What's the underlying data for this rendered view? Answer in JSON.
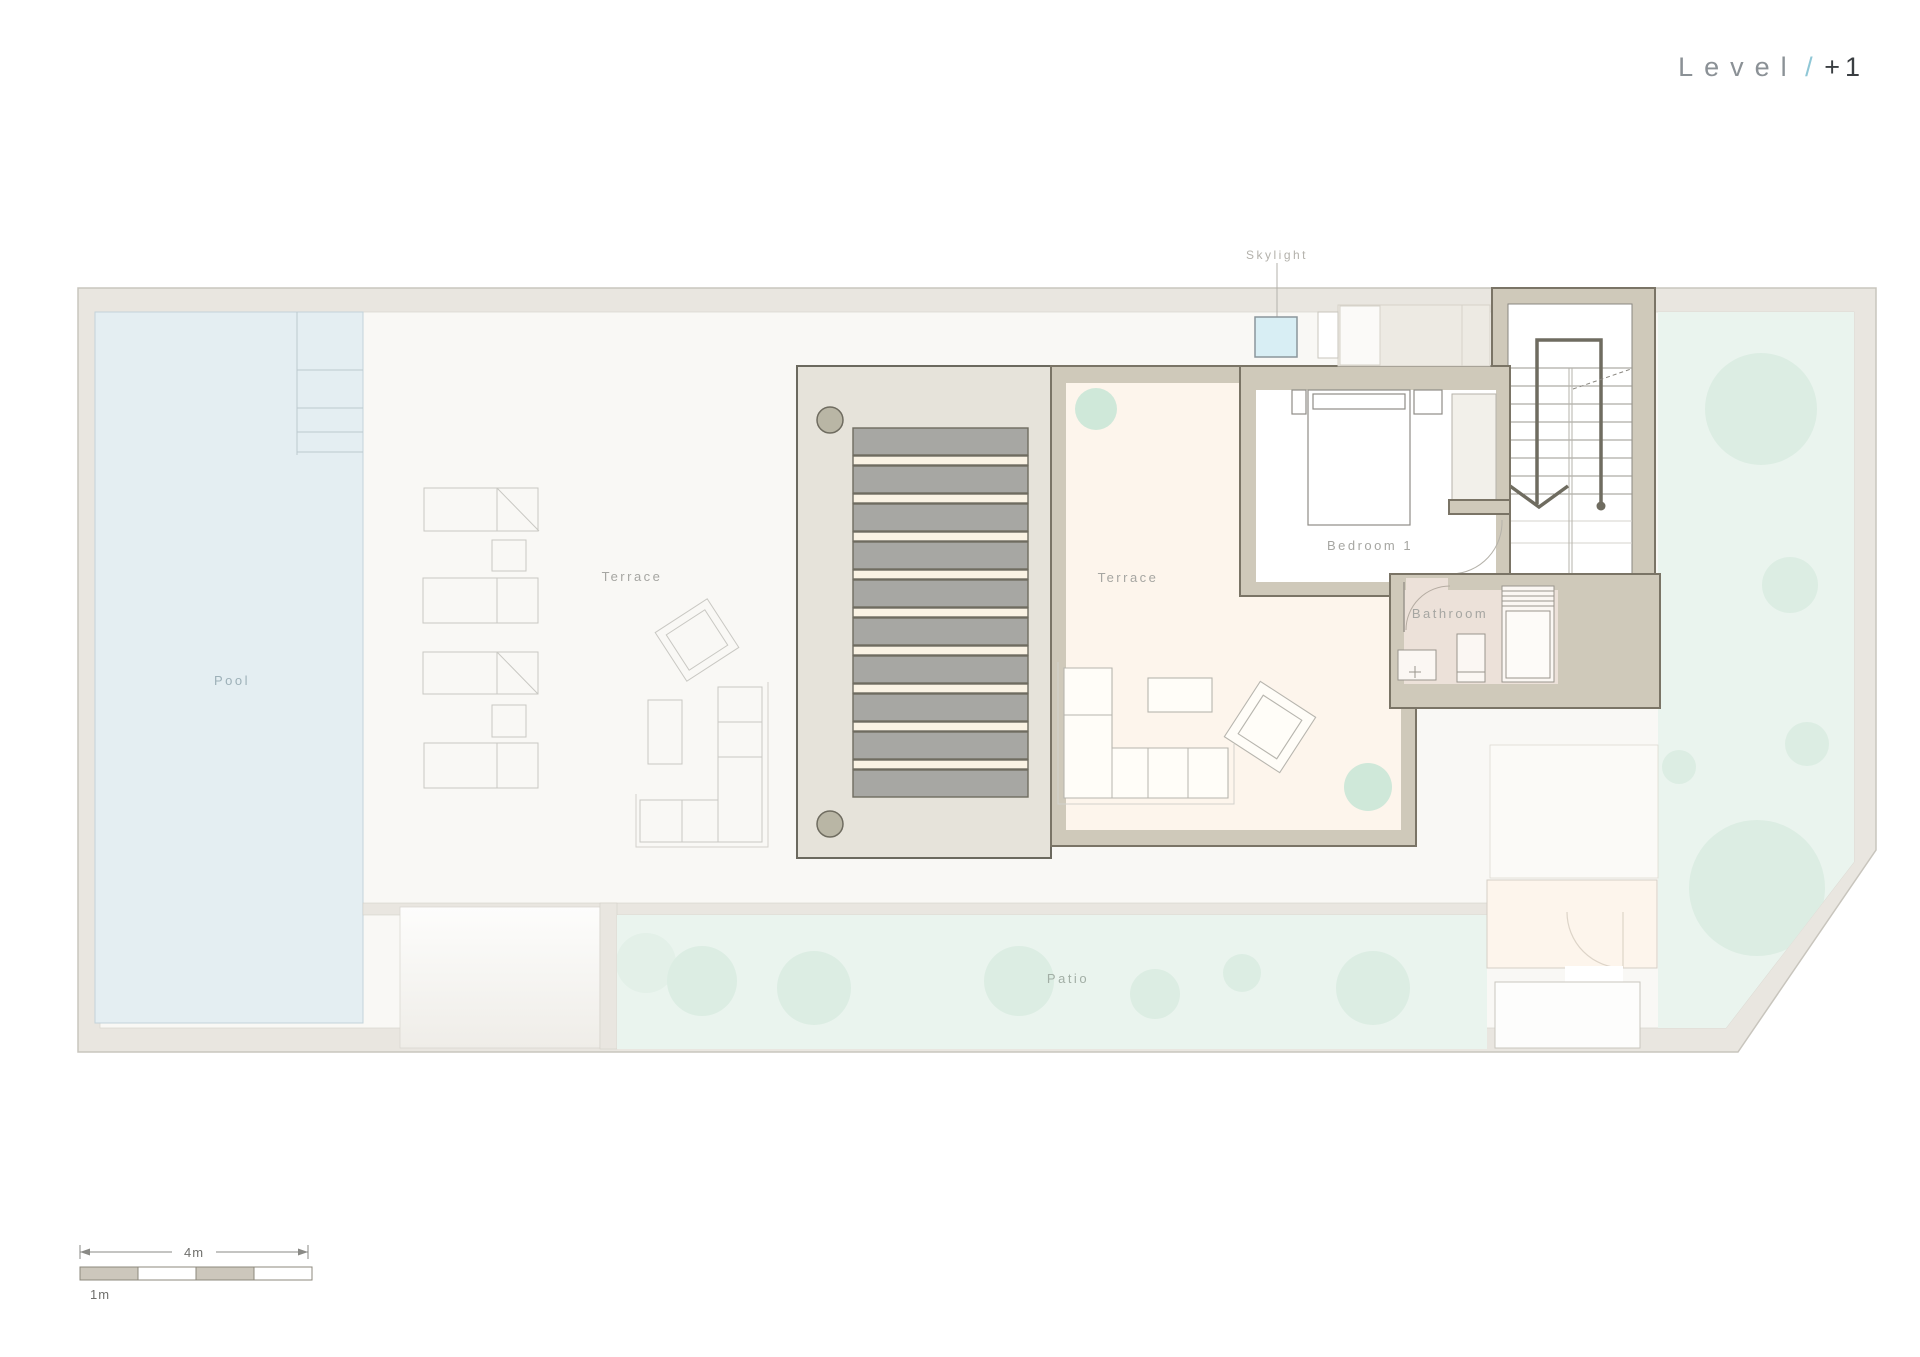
{
  "title": {
    "word": "Level",
    "slash": "/",
    "number": "+1"
  },
  "labels": {
    "pool": "Pool",
    "terrace_outdoor": "Terrace",
    "terrace_main": "Terrace",
    "bedroom": "Bedroom 1",
    "bathroom": "Bathroom",
    "skylight": "Skylight",
    "patio": "Patio"
  },
  "scale_bar": {
    "total_label": "4m",
    "unit_label": "1m"
  },
  "colors": {
    "pool": "#e4eef2",
    "green": "#eaf4ee",
    "tree": "#dcede3",
    "tree_dark": "#cfe8d9",
    "wall": "#cfc9ba",
    "wall_stroke": "#7a7466",
    "floor_cream": "#fdf5ec",
    "floor_bath": "#ece1d9",
    "skylight": "#d8eef4",
    "pergola_bg": "#e6e3da",
    "slat_gray": "#a7a7a3",
    "slat_cream": "#faf3e4",
    "site_border": "#e9e6e0",
    "ground": "#f9f8f5",
    "accent": "#8fc7d6",
    "title_dark": "#3a3e42",
    "title_gray": "#8b9196",
    "label_gray": "#a6a6a2"
  }
}
